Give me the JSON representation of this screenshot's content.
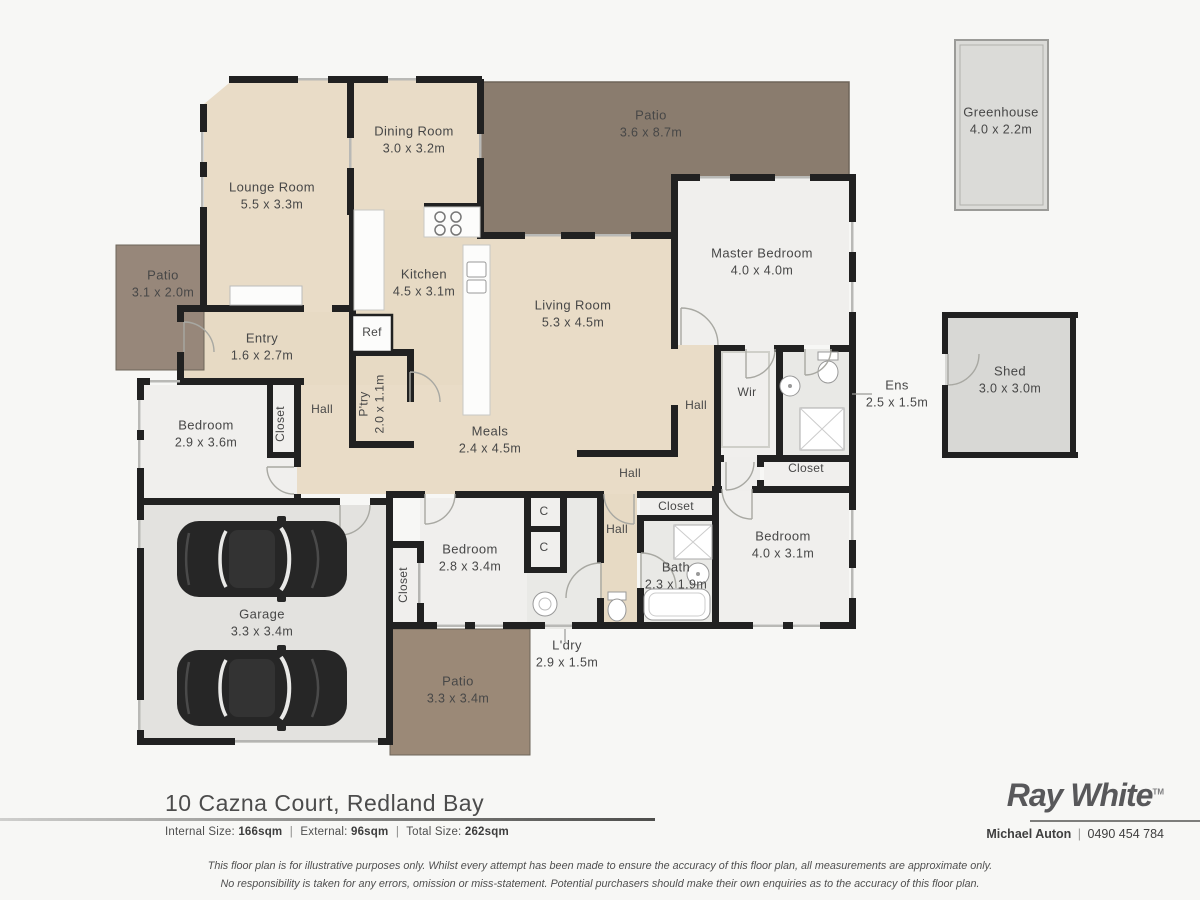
{
  "floor_plan": {
    "labels": [
      {
        "id": "lounge-room",
        "name": "Lounge Room",
        "dims": "5.5 x 3.3m",
        "x": 272,
        "y": 196
      },
      {
        "id": "dining-room",
        "name": "Dining Room",
        "dims": "3.0 x 3.2m",
        "x": 414,
        "y": 140
      },
      {
        "id": "patio-top",
        "name": "Patio",
        "dims": "3.6 x 8.7m",
        "x": 651,
        "y": 124
      },
      {
        "id": "greenhouse",
        "name": "Greenhouse",
        "dims": "4.0 x 2.2m",
        "x": 1001,
        "y": 121
      },
      {
        "id": "master-bedroom",
        "name": "Master Bedroom",
        "dims": "4.0 x 4.0m",
        "x": 762,
        "y": 262
      },
      {
        "id": "patio-left",
        "name": "Patio",
        "dims": "3.1 x 2.0m",
        "x": 163,
        "y": 284
      },
      {
        "id": "kitchen",
        "name": "Kitchen",
        "dims": "4.5 x 3.1m",
        "x": 424,
        "y": 283
      },
      {
        "id": "living-room",
        "name": "Living Room",
        "dims": "5.3 x 4.5m",
        "x": 573,
        "y": 314
      },
      {
        "id": "entry",
        "name": "Entry",
        "dims": "1.6 x 2.7m",
        "x": 262,
        "y": 347
      },
      {
        "id": "ref",
        "name": "Ref",
        "x": 372,
        "y": 333,
        "small": true
      },
      {
        "id": "pantry",
        "name": "P'try",
        "dims": "2.0 x 1.1m",
        "x": 372,
        "y": 404,
        "rot": true,
        "small": true
      },
      {
        "id": "hall-west",
        "name": "Hall",
        "x": 322,
        "y": 410,
        "small": true
      },
      {
        "id": "hall-master",
        "name": "Hall",
        "x": 696,
        "y": 406,
        "small": true
      },
      {
        "id": "wir",
        "name": "Wir",
        "x": 747,
        "y": 393,
        "small": true
      },
      {
        "id": "ens",
        "name": "Ens",
        "dims": "2.5 x 1.5m",
        "x": 897,
        "y": 394
      },
      {
        "id": "shed",
        "name": "Shed",
        "dims": "3.0 x 3.0m",
        "x": 1010,
        "y": 380
      },
      {
        "id": "closet-bedroom1",
        "name": "Closet",
        "x": 281,
        "y": 424,
        "rot": true,
        "small": true
      },
      {
        "id": "bedroom-1",
        "name": "Bedroom",
        "dims": "2.9 x 3.6m",
        "x": 206,
        "y": 434
      },
      {
        "id": "meals",
        "name": "Meals",
        "dims": "2.4 x 4.5m",
        "x": 490,
        "y": 440
      },
      {
        "id": "closet-ens",
        "name": "Closet",
        "x": 806,
        "y": 469,
        "small": true
      },
      {
        "id": "hall-centre",
        "name": "Hall",
        "x": 630,
        "y": 474,
        "small": true
      },
      {
        "id": "closet-bedroom4",
        "name": "Closet",
        "x": 676,
        "y": 507,
        "small": true
      },
      {
        "id": "hall-south",
        "name": "Hall",
        "x": 617,
        "y": 530,
        "small": true
      },
      {
        "id": "bedroom-4",
        "name": "Bedroom",
        "dims": "4.0 x 3.1m",
        "x": 783,
        "y": 545
      },
      {
        "id": "bedroom-28",
        "name": "Bedroom",
        "dims": "2.8 x 3.4m",
        "x": 470,
        "y": 558
      },
      {
        "id": "bath",
        "name": "Bath",
        "dims": "2.3 x 1.9m",
        "x": 676,
        "y": 576
      },
      {
        "id": "closet-c1",
        "name": "C",
        "x": 544,
        "y": 512,
        "small": true
      },
      {
        "id": "closet-c2",
        "name": "C",
        "x": 544,
        "y": 548,
        "small": true
      },
      {
        "id": "closet-garage",
        "name": "Closet",
        "x": 404,
        "y": 585,
        "rot": true,
        "small": true
      },
      {
        "id": "garage",
        "name": "Garage",
        "dims": "3.3 x 3.4m",
        "x": 262,
        "y": 623
      },
      {
        "id": "laundry",
        "name": "L'dry",
        "dims": "2.9 x 1.5m",
        "x": 567,
        "y": 654
      },
      {
        "id": "patio-bottom",
        "name": "Patio",
        "dims": "3.3 x 3.4m",
        "x": 458,
        "y": 690
      }
    ]
  },
  "footer": {
    "address": "10 Cazna Court, Redland Bay",
    "internal_label": "Internal Size:",
    "internal_value": "166sqm",
    "external_label": "External:",
    "external_value": "96sqm",
    "total_label": "Total Size:",
    "total_value": "262sqm",
    "separator": "|",
    "brand": "Ray White",
    "brand_tm": "TM",
    "agent_name": "Michael Auton",
    "agent_phone": "0490 454 784",
    "disclaimer_line1": "This floor plan is for illustrative purposes only. Whilst every attempt has been made to ensure the accuracy of this floor plan, all measurements are approximate only.",
    "disclaimer_line2": "No responsibility is taken for any errors, omission or miss-statement. Potential purchasers should make their own enquiries as to the accuracy of this floor plan."
  },
  "colors": {
    "wall": "#212121",
    "wood_floor": "#e9dcc7",
    "plaster_floor": "#f0efed",
    "tile_floor": "#e9e9e6",
    "patio_dark": "#8a7c6e",
    "garage_floor": "#e3e2df",
    "brand_gray": "#58585a"
  }
}
